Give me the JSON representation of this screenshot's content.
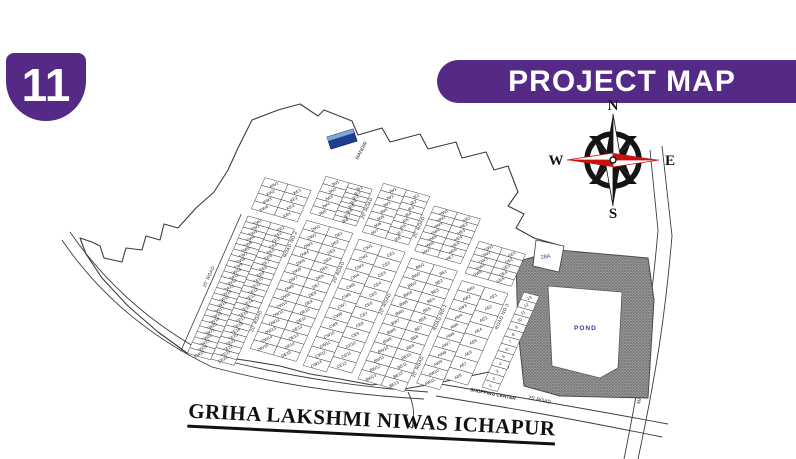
{
  "badge": {
    "number": "11"
  },
  "banner": {
    "title": "PROJECT MAP",
    "color": "#552a87"
  },
  "compass": {
    "north": "N",
    "south": "S",
    "east": "E",
    "west": "W",
    "accent_color": "#cc1111",
    "line_color": "#141414"
  },
  "map": {
    "title": "GRIHA LAKSHMI NIWAS  ICHAPUR",
    "landmark": {
      "label": "MANDIR"
    },
    "pond": {
      "label": "POND",
      "label_color": "#33399b"
    },
    "special_plot": {
      "label": "28A",
      "label_color": "#33399b"
    },
    "roads": {
      "road_20": "20' ROAD",
      "road_25": "25' ROAD",
      "road_no_1": "ROAD NO.1",
      "road_no_2": "ROAD NO.2",
      "road_no_3": "ROAD NO.3",
      "main_road": "MAIN ROAD",
      "shopping_center": "SHOPPING CENTER"
    },
    "strips": [
      {
        "id": "strip-E-K",
        "lower": [
          {
            "prefix": "EW",
            "count": 25
          },
          {
            "prefix": "EE",
            "count": 24
          }
        ],
        "upper": [
          {
            "prefix": "KW",
            "count": 4
          },
          {
            "prefix": "KE",
            "count": 4
          }
        ]
      },
      {
        "id": "strip-D-J",
        "lower": [
          {
            "prefix": "DW",
            "count": 15
          },
          {
            "prefix": "DE",
            "count": 15
          }
        ],
        "upper": [
          {
            "prefix": "JW",
            "count": 5
          },
          {
            "prefix": "JE",
            "count": 8
          }
        ]
      },
      {
        "id": "strip-C-I",
        "lower": [
          {
            "prefix": "CW",
            "count": 13
          },
          {
            "prefix": "CE",
            "count": 12
          }
        ],
        "upper": [
          {
            "prefix": "IW",
            "count": 7
          },
          {
            "prefix": "IE",
            "count": 8
          }
        ]
      },
      {
        "id": "strip-B-H",
        "lower": [
          {
            "prefix": "BW",
            "count": 13
          },
          {
            "prefix": "BE",
            "count": 13
          }
        ],
        "upper": [
          {
            "prefix": "HW",
            "count": 7
          },
          {
            "prefix": "HE",
            "count": 7
          }
        ]
      },
      {
        "id": "strip-A-G",
        "lower": [
          {
            "prefix": "AW",
            "count": 11
          },
          {
            "prefix": "AE",
            "count": 8
          }
        ],
        "upper": [
          {
            "prefix": "GW",
            "count": 5
          },
          {
            "prefix": "GE",
            "count": 5
          }
        ]
      }
    ],
    "numbered_plots": {
      "start": 1,
      "end": 13
    }
  }
}
